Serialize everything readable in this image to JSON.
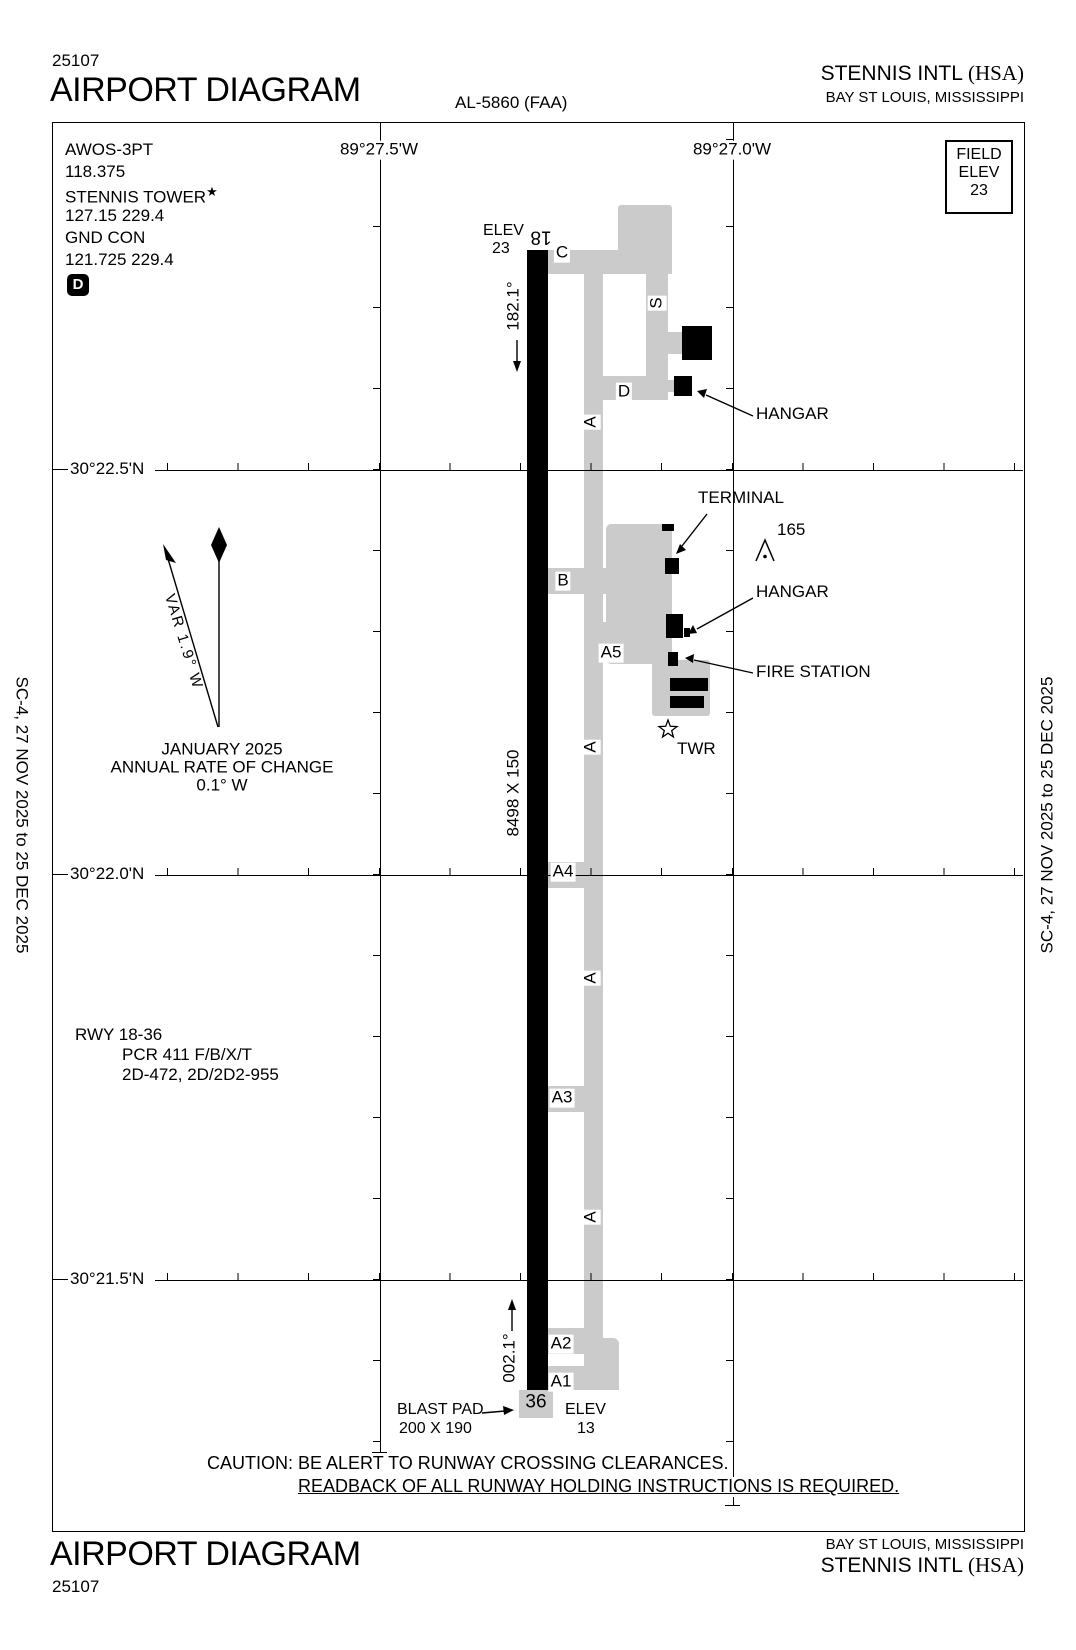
{
  "header": {
    "chart_number": "25107",
    "title": "AIRPORT DIAGRAM",
    "chart_code": "AL-5860 (FAA)",
    "airport_name": "STENNIS INTL",
    "airport_id": "(HSA)",
    "city_state": "BAY ST LOUIS, MISSISSIPPI"
  },
  "side_text": "SC-4,  27 NOV 2025  to  25 DEC 2025",
  "field_elev": {
    "line1": "FIELD",
    "line2": "ELEV",
    "value": "23"
  },
  "comms": {
    "awos_label": "AWOS-3PT",
    "awos_freq": "118.375",
    "tower_label": "STENNIS TOWER",
    "tower_star": "★",
    "tower_freqs": "127.15  229.4",
    "gnd_label": "GND CON",
    "gnd_freqs": "121.725  229.4",
    "d_symbol": "D"
  },
  "grid": {
    "lon_labels": [
      "89°27.5'W",
      "89°27.0'W"
    ],
    "lat_labels": [
      "30°22.5'N",
      "30°22.0'N",
      "30°21.5'N"
    ]
  },
  "compass": {
    "var_label": "VAR 1.9° W",
    "date": "JANUARY 2025",
    "rate_line1": "ANNUAL RATE OF CHANGE",
    "rate_line2": "0.1° W"
  },
  "runway": {
    "num_north": "18",
    "num_south": "36",
    "elev_label": "ELEV",
    "elev_north": "23",
    "elev_south": "13",
    "hdg_south": "182.1°",
    "hdg_north": "002.1°",
    "dimensions": "8498 X 150",
    "blast_pad_label": "BLAST PAD",
    "blast_pad_size": "200 X 190"
  },
  "rwy_info": {
    "line1": "RWY 18-36",
    "line2": "PCR 411 F/B/X/T",
    "line3": "2D-472, 2D/2D2-955"
  },
  "taxiways": {
    "a": "A",
    "b": "B",
    "c": "C",
    "d": "D",
    "s": "S",
    "a1": "A1",
    "a2": "A2",
    "a3": "A3",
    "a4": "A4",
    "a5": "A5"
  },
  "features": {
    "terminal": "TERMINAL",
    "hangar": "HANGAR",
    "fire_station": "FIRE STATION",
    "tower": "TWR",
    "obstacle_height": "165"
  },
  "caution": {
    "line1": "CAUTION: BE ALERT TO RUNWAY CROSSING CLEARANCES.",
    "line2": "READBACK OF ALL RUNWAY HOLDING INSTRUCTIONS IS REQUIRED."
  },
  "colors": {
    "taxiway_gray": "#cbcbcb",
    "ink": "#000000"
  }
}
